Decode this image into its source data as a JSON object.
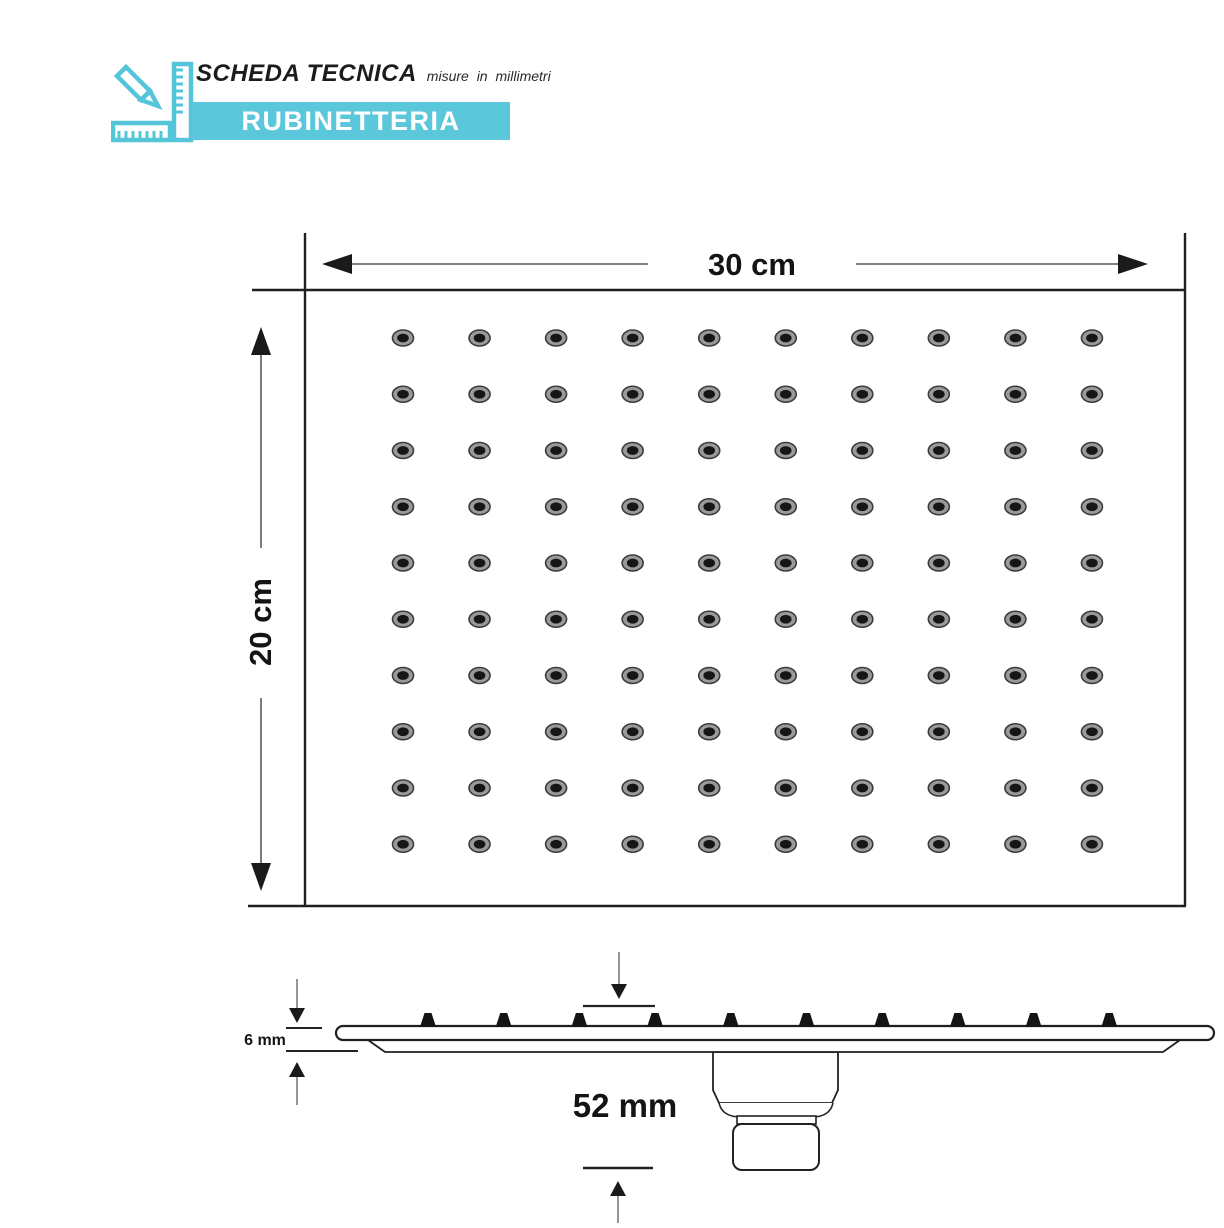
{
  "header": {
    "icon": "pencil-ruler-icon",
    "title": "SCHEDA TECNICA",
    "subtitle": "misure in millimetri",
    "brand": "RUBINETTERIA",
    "accent_color": "#5bc7db"
  },
  "face_view": {
    "description": "shower head face with nozzle grid",
    "width_label": "30 cm",
    "height_label": "20 cm",
    "grid": {
      "rows": 10,
      "cols": 10
    },
    "dot_ring_color": "#9a9a9a",
    "dot_center_color": "#161616"
  },
  "side_view": {
    "description": "shower head side profile with connector",
    "thickness_label": "6 mm",
    "height_label": "52 mm",
    "nozzle_count": 10
  }
}
